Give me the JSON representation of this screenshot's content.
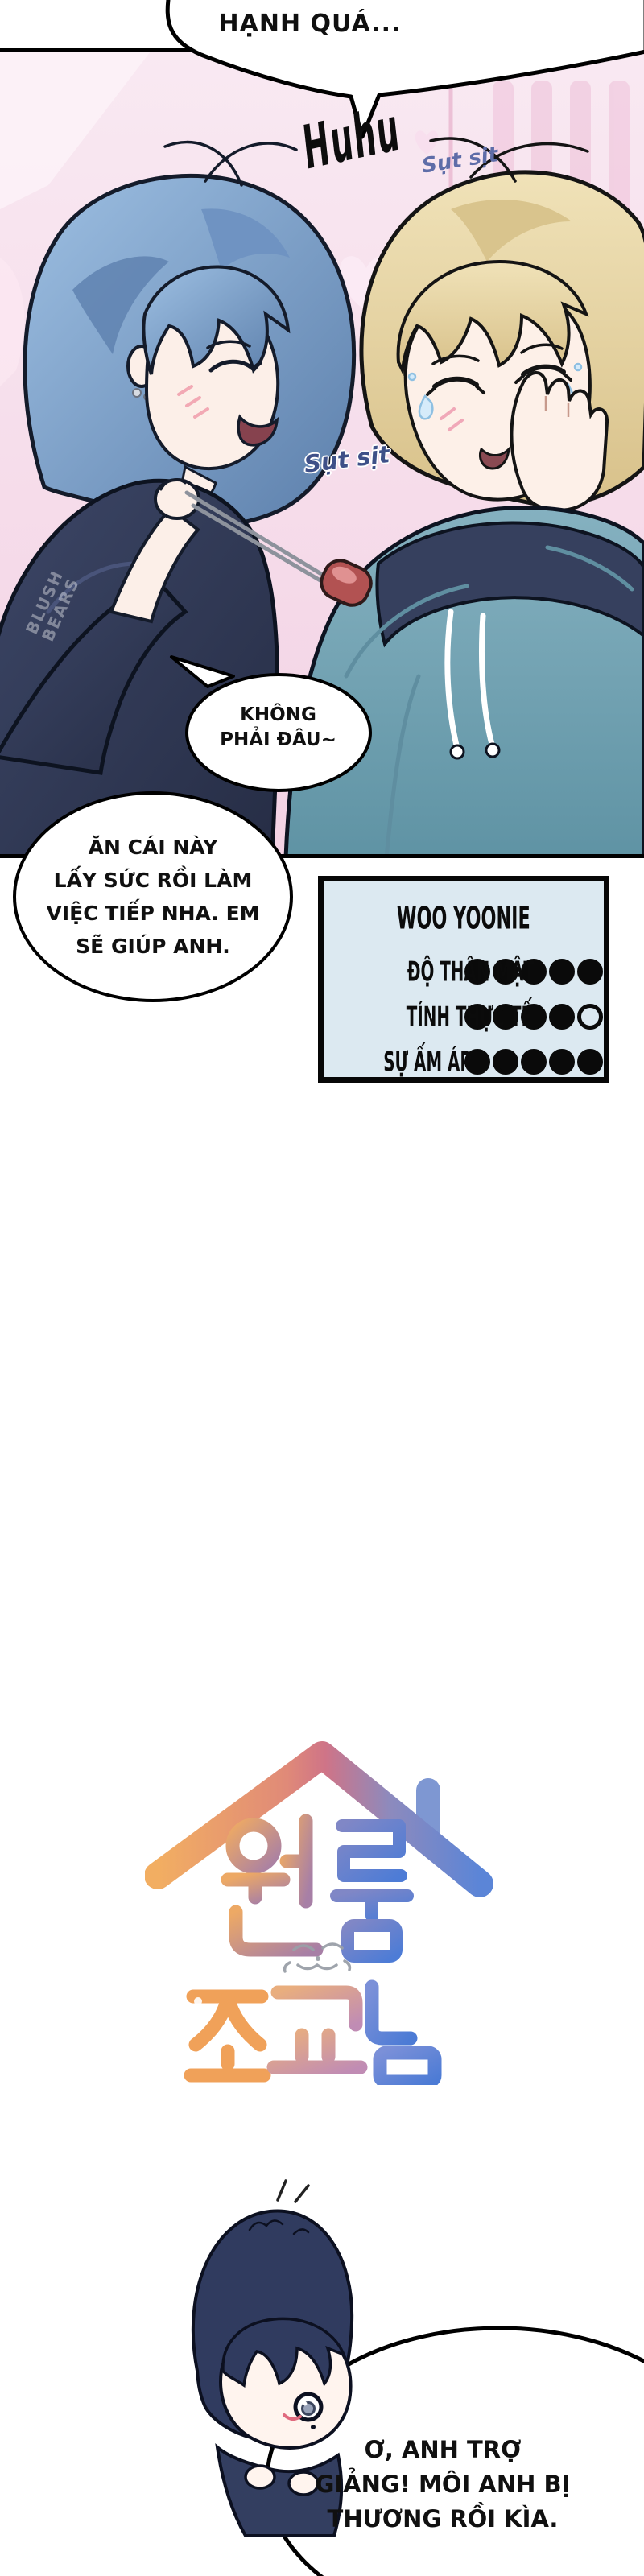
{
  "comic": {
    "top_bubble": "HẠNH QUÁ...",
    "sfx_sob": "Huhu",
    "sfx_sniffle_right": "Sụt sịt",
    "sfx_sniffle_left": "Sụt sịt",
    "small_bubble": [
      "KHÔNG",
      "PHẢI ĐÂU~"
    ],
    "big_bubble": [
      "ĂN CÁI NÀY",
      "LẤY SỨC RỒI LÀM",
      "VIỆC TIẾP NHA. EM",
      "SẼ GIÚP ANH."
    ],
    "bottom_bubble": [
      "Ơ, ANH TRỢ",
      "GIẢNG! MÔI ANH BỊ",
      "THƯƠNG RỒI KÌA."
    ],
    "watermark": [
      "BLUSH",
      "BEARS"
    ]
  },
  "stats_card": {
    "title": "WOO YOONIE",
    "rows": [
      {
        "label": "ĐỘ THÂN MẬT",
        "filled": 5,
        "total": 5
      },
      {
        "label": "TÍNH THỰC TẾ",
        "filled": 4,
        "total": 5
      },
      {
        "label": "SỰ ẤM ÁP",
        "filled": 5,
        "total": 5
      }
    ]
  },
  "logo": {
    "line1": "원룸",
    "line2": "조교님"
  },
  "colors": {
    "panel_pink": "#f6dcea",
    "stats_bg": "#dce9f1",
    "hair_blue": "#89aed6",
    "hair_blond": "#ecdcae",
    "hoodie_teal": "#7ca9ba",
    "shirt_navy": "#323a54",
    "sfx_blue": "#5e6da8",
    "logo_orange": "#f0a159",
    "logo_blue": "#5b85d7"
  }
}
